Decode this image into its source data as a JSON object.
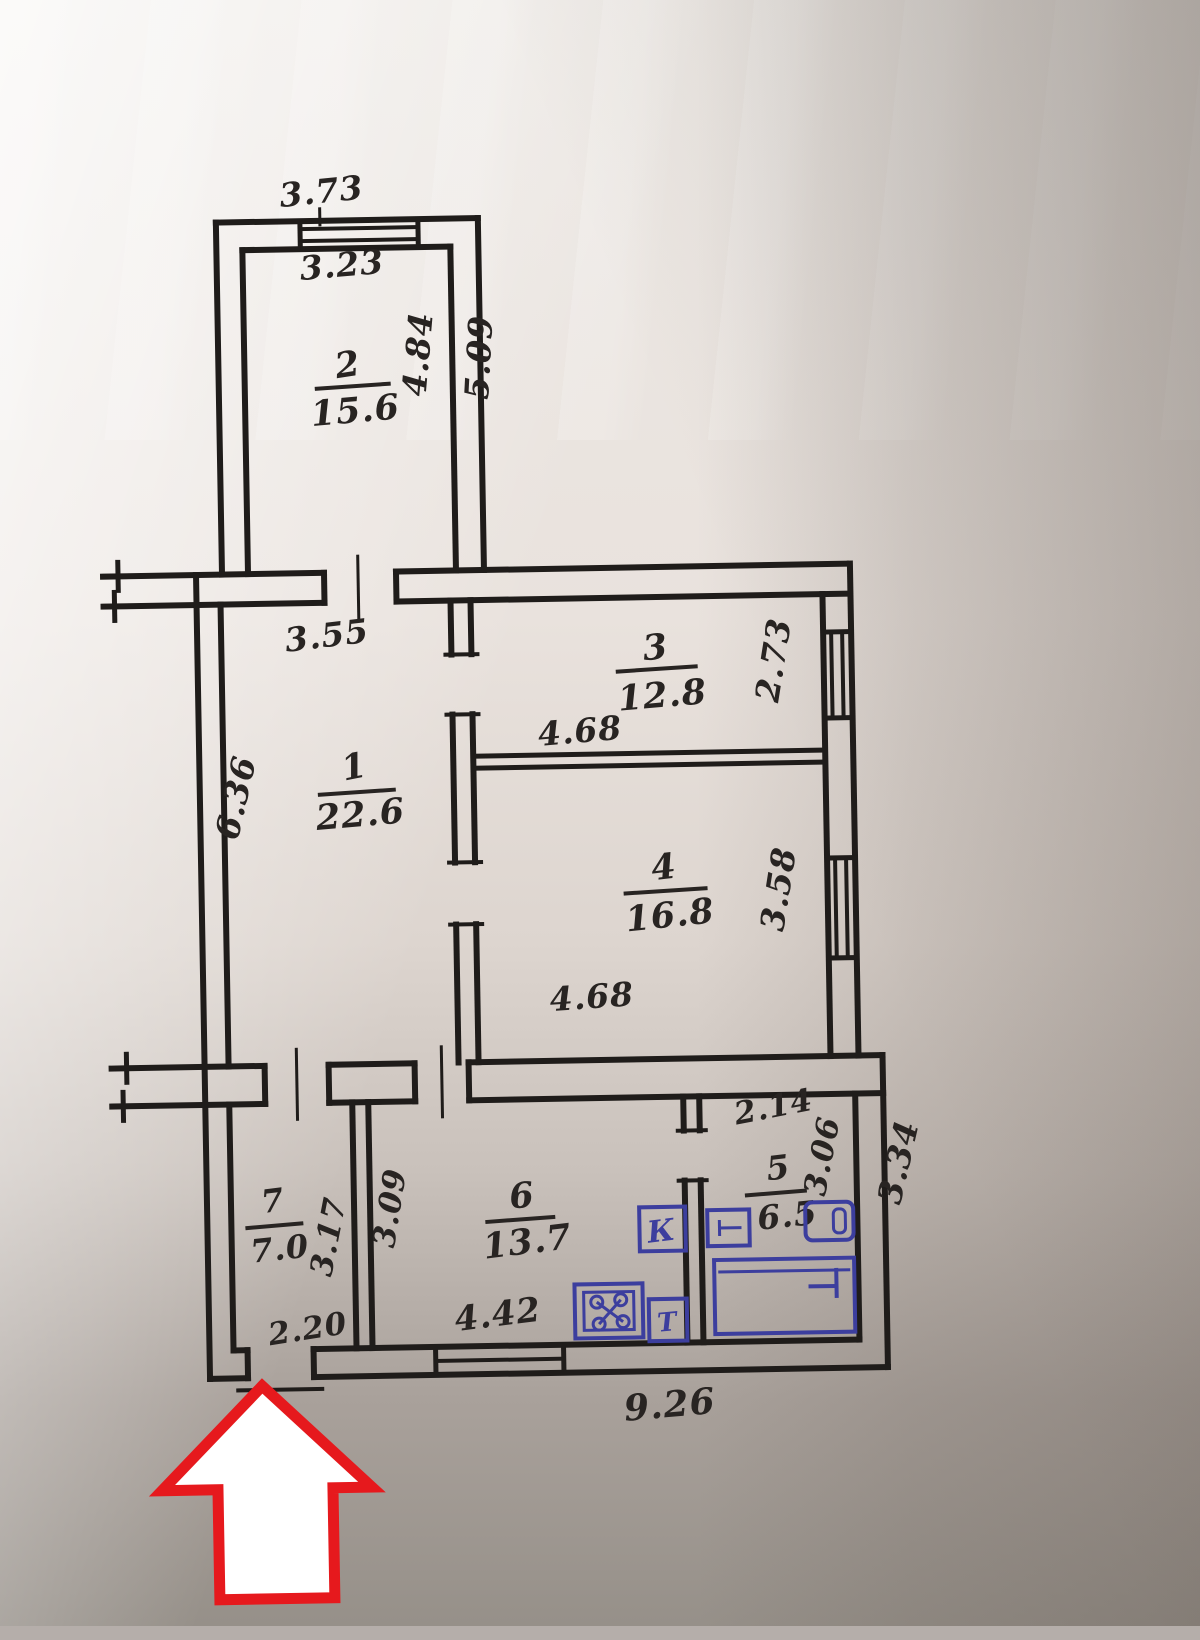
{
  "plan": {
    "rooms": [
      {
        "number": "2",
        "area": "15.6"
      },
      {
        "number": "3",
        "area": "12.8"
      },
      {
        "number": "1",
        "area": "22.6"
      },
      {
        "number": "4",
        "area": "16.8"
      },
      {
        "number": "7",
        "area": "7.0"
      },
      {
        "number": "6",
        "area": "13.7"
      },
      {
        "number": "5",
        "area": "6.5"
      }
    ],
    "dimensions": {
      "top_window_width": "3.73",
      "room2_width": "3.23",
      "room2_height": "4.84",
      "room2_height_outer": "5.09",
      "room1_top_width": "3.55",
      "room1_height": "6.36",
      "room3_width": "4.68",
      "room3_height": "2.73",
      "room4_width": "4.68",
      "room4_height": "3.58",
      "room7_height_left": "3.17",
      "room7_height_right": "3.09",
      "room7_door_width": "2.20",
      "room6_width": "4.42",
      "room5_top_width": "2.14",
      "room5_height": "3.06",
      "bottom_block_height": "3.34",
      "bottom_total_width": "9.26"
    },
    "fixtures": {
      "boiler": "К",
      "heater": "Т"
    },
    "colors": {
      "ink": "#1f1c1a",
      "blue": "#3c3e9e",
      "red": "#e6191d",
      "paper": "#e7e1dc"
    }
  }
}
